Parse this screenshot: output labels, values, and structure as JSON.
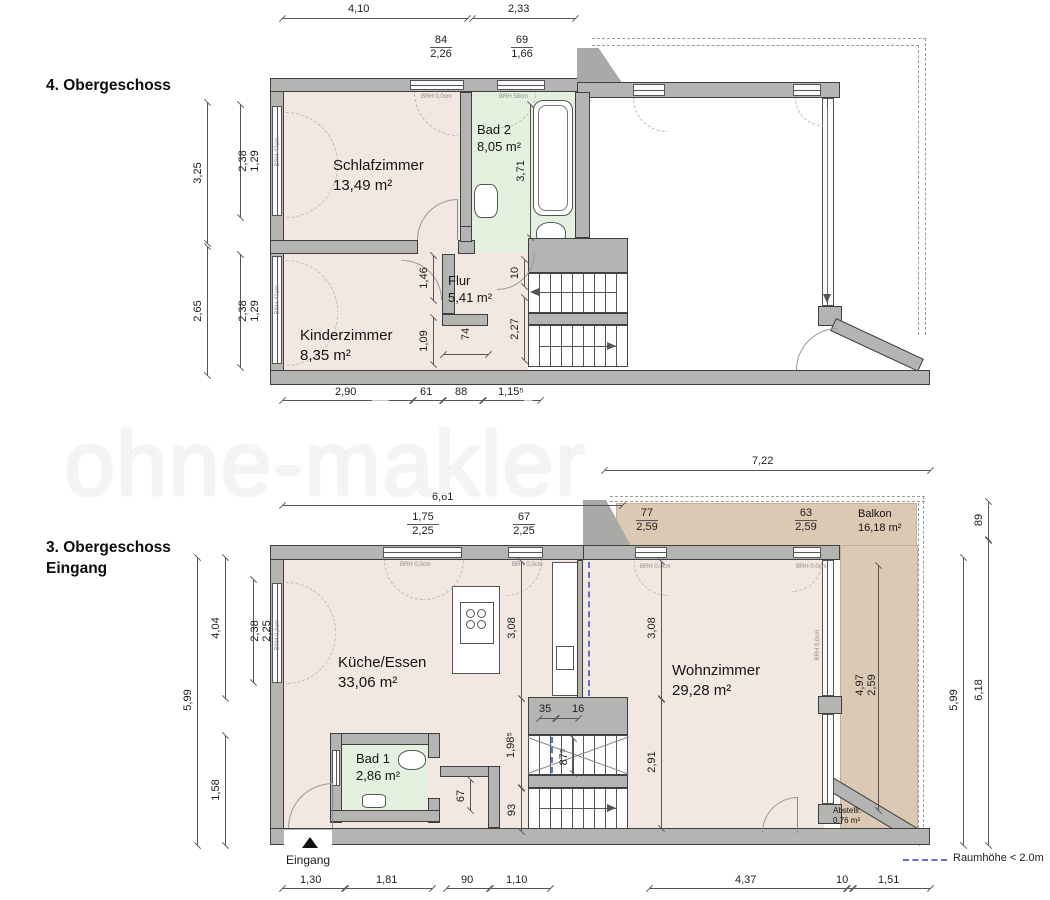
{
  "page": {
    "floor4_title": "4. Obergeschoss",
    "floor3_title_line1": "3. Obergeschoss",
    "floor3_title_line2": "Eingang"
  },
  "watermark": {
    "text": "ohne-makler"
  },
  "legend": {
    "label": "Raumhöhe < 2.0m"
  },
  "floor4": {
    "rooms": {
      "schlafzimmer": {
        "name": "Schlafzimmer",
        "area": "13,49 m²"
      },
      "bad2": {
        "name": "Bad 2",
        "area": "8,05 m²"
      },
      "flur": {
        "name": "Flur",
        "area": "5,41 m²"
      },
      "kinderzimmer": {
        "name": "Kinderzimmer",
        "area": "8,35 m²"
      }
    },
    "dims": {
      "top_a": "4,10",
      "top_b": "2,33",
      "win1_a": "84",
      "win1_b": "2,26",
      "win2_a": "69",
      "win2_b": "1,66",
      "left_a": "3,25",
      "left_b": "2,65",
      "left_in1a": "2,38",
      "left_in1b": "1,29",
      "left_in2a": "2,38",
      "left_in2b": "1,29",
      "bad2_h": "3,71",
      "flur_146": "1,46",
      "flur_74": "74",
      "flur_109": "1,09",
      "flur_227": "2,27",
      "flur_10": "10",
      "bot_a": "2,90",
      "bot_b": "61",
      "bot_c": "88",
      "bot_d": "1,15⁵"
    },
    "brh": {
      "top1": "BRH 0,0cm",
      "top2": "BRH 58cm",
      "left1": "BRH 47cm",
      "left2": "BRH 47cm"
    }
  },
  "floor3": {
    "rooms": {
      "kueche": {
        "name": "Küche/Essen",
        "area": "33,06 m²"
      },
      "bad1": {
        "name": "Bad 1",
        "area": "2,86 m²"
      },
      "wohnzimmer": {
        "name": "Wohnzimmer",
        "area": "29,28 m²"
      },
      "balkon": {
        "name": "Balkon",
        "area": "16,18 m²"
      },
      "abstellraum": {
        "name": "Abstellr.",
        "area": "0,76 m²"
      }
    },
    "eingang_label": "Eingang",
    "dims": {
      "top_722": "7,22",
      "top_661": "6,61",
      "win1_a": "1,75",
      "win1_b": "2,25",
      "win2_a": "67",
      "win2_b": "2,25",
      "win3_a": "77",
      "win3_b": "2,59",
      "win4_a": "63",
      "win4_b": "2,59",
      "left_599": "5,99",
      "left_404": "4,04",
      "left_158": "1,58",
      "left_in_a": "2,38",
      "left_in_b": "2,25",
      "k_308": "3,08",
      "w_308": "3,08",
      "w_291": "2,91",
      "st_35": "35",
      "st_16": "16",
      "st_875": "87⁵",
      "st_1985": "1,98⁵",
      "st_93": "93",
      "bad1_67": "67",
      "balkon_a": "4,97",
      "balkon_b": "2,59",
      "right_89": "89",
      "right_618": "6,18",
      "right_599": "5,99",
      "bot_130": "1,30",
      "bot_181": "1,81",
      "bot_90": "90",
      "bot_110": "1,10",
      "bot_437": "4,37",
      "bot_10": "10",
      "bot_151": "1,51"
    },
    "brh": {
      "top1": "BRH 0,0cm",
      "top2": "BRH 0,0cm",
      "top3": "BRH 0,0cm",
      "top4": "BRH 0,0cm",
      "left": "BRH 0,0cm",
      "right": "BRH 0,0cm"
    }
  }
}
